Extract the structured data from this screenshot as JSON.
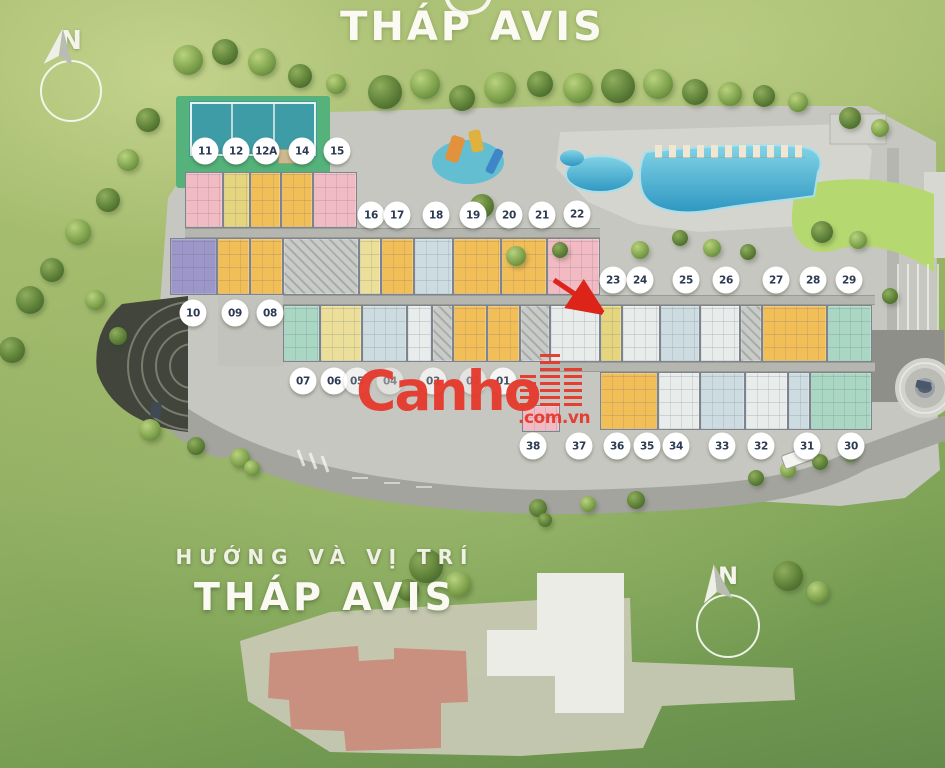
{
  "header": {
    "title": "THÁP AVIS"
  },
  "compass_top": {
    "label": "N"
  },
  "watermark": {
    "brand": "Canho",
    "suffix": ".com.vn",
    "icon": "buildings-icon",
    "color": "#e63a2e"
  },
  "footer": {
    "subtitle": "HƯỚNG VÀ VỊ TRÍ",
    "title": "THÁP AVIS",
    "compass_label": "N"
  },
  "colors": {
    "marker_text": "#2b3a52",
    "wm_red": "#e63a2e",
    "title_white": "#fafaf2",
    "unit_pink": "#f2bbc3",
    "unit_yellow": "#e4d57e",
    "unit_orange": "#f2be58",
    "unit_ltyellow": "#ebdf9a",
    "unit_purple": "#9d96c8",
    "unit_blue": "#cddce0",
    "unit_teal": "#a9d7c3",
    "unit_white": "#e8ecea",
    "unit_core": "#c9cbc6",
    "highlight_footprint": "#c9907f",
    "pool_blue": "#3fa8cc",
    "tennis_teal": "#3d9ca6"
  },
  "site_plan": {
    "amenities": [
      "tennis-court",
      "kids-playground",
      "swimming-pool",
      "kids-pool",
      "sun-loungers",
      "clubhouse",
      "amphitheater",
      "roundabout",
      "parking",
      "lawn",
      "internal-road"
    ],
    "unit_markers": [
      {
        "label": "11",
        "x": 205,
        "y": 151
      },
      {
        "label": "12",
        "x": 236,
        "y": 151
      },
      {
        "label": "12A",
        "x": 266,
        "y": 151
      },
      {
        "label": "14",
        "x": 302,
        "y": 151
      },
      {
        "label": "15",
        "x": 337,
        "y": 151
      },
      {
        "label": "16",
        "x": 371,
        "y": 215
      },
      {
        "label": "17",
        "x": 397,
        "y": 215
      },
      {
        "label": "18",
        "x": 436,
        "y": 215
      },
      {
        "label": "19",
        "x": 473,
        "y": 215
      },
      {
        "label": "20",
        "x": 509,
        "y": 215
      },
      {
        "label": "21",
        "x": 542,
        "y": 215
      },
      {
        "label": "22",
        "x": 577,
        "y": 214
      },
      {
        "label": "23",
        "x": 613,
        "y": 280
      },
      {
        "label": "24",
        "x": 640,
        "y": 280
      },
      {
        "label": "25",
        "x": 686,
        "y": 280
      },
      {
        "label": "26",
        "x": 726,
        "y": 280
      },
      {
        "label": "27",
        "x": 776,
        "y": 280
      },
      {
        "label": "28",
        "x": 813,
        "y": 280
      },
      {
        "label": "29",
        "x": 849,
        "y": 280
      },
      {
        "label": "10",
        "x": 193,
        "y": 313
      },
      {
        "label": "09",
        "x": 235,
        "y": 313
      },
      {
        "label": "08",
        "x": 270,
        "y": 313
      },
      {
        "label": "07",
        "x": 303,
        "y": 381
      },
      {
        "label": "06",
        "x": 334,
        "y": 381
      },
      {
        "label": "05",
        "x": 357,
        "y": 381,
        "opacity": 0.75
      },
      {
        "label": "04",
        "x": 390,
        "y": 381,
        "opacity": 0.45
      },
      {
        "label": "03",
        "x": 433,
        "y": 381,
        "opacity": 0.7
      },
      {
        "label": "02",
        "x": 473,
        "y": 381,
        "opacity": 0.5
      },
      {
        "label": "01",
        "x": 503,
        "y": 381,
        "opacity": 0.85
      },
      {
        "label": "38",
        "x": 533,
        "y": 446
      },
      {
        "label": "37",
        "x": 579,
        "y": 446
      },
      {
        "label": "36",
        "x": 617,
        "y": 446
      },
      {
        "label": "35",
        "x": 647,
        "y": 446
      },
      {
        "label": "34",
        "x": 676,
        "y": 446
      },
      {
        "label": "33",
        "x": 722,
        "y": 446
      },
      {
        "label": "32",
        "x": 761,
        "y": 446
      },
      {
        "label": "31",
        "x": 807,
        "y": 446
      },
      {
        "label": "30",
        "x": 851,
        "y": 446
      }
    ]
  }
}
